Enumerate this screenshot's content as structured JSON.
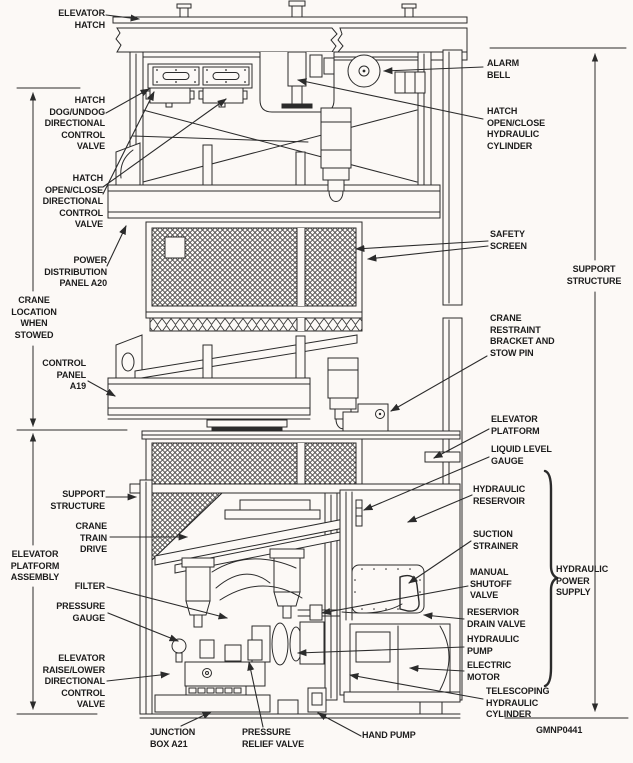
{
  "figure": {
    "code": "GMNP0441",
    "background": "#fcf9f6",
    "ink_color": "#2b2b2b",
    "subject": "Elevator platform assembly and hydraulic power supply cutaway diagram"
  },
  "labels": {
    "elevator_hatch": "ELEVATOR\nHATCH",
    "hatch_dog_undog": "HATCH\nDOG/UNDOG\nDIRECTIONAL\nCONTROL\nVALVE",
    "hatch_open_close_valve": "HATCH\nOPEN/CLOSE\nDIRECTIONAL\nCONTROL\nVALVE",
    "power_distribution": "POWER\nDISTRIBUTION\nPANEL A20",
    "crane_location": "CRANE\nLOCATION\nWHEN\nSTOWED",
    "control_panel": "CONTROL\nPANEL\nA19",
    "support_structure_left": "SUPPORT\nSTRUCTURE",
    "crane_train_drive": "CRANE\nTRAIN\nDRIVE",
    "elevator_platform_assembly": "ELEVATOR\nPLATFORM\nASSEMBLY",
    "filter": "FILTER",
    "pressure_gauge": "PRESSURE\nGAUGE",
    "elevator_raise_lower": "ELEVATOR\nRAISE/LOWER\nDIRECTIONAL\nCONTROL\nVALVE",
    "junction_box": "JUNCTION\nBOX A21",
    "pressure_relief_valve": "PRESSURE\nRELIEF VALVE",
    "hand_pump": "HAND PUMP",
    "alarm_bell": "ALARM\nBELL",
    "hatch_cylinder": "HATCH\nOPEN/CLOSE\nHYDRAULIC\nCYLINDER",
    "safety_screen": "SAFETY\nSCREEN",
    "support_structure_right": "SUPPORT\nSTRUCTURE",
    "crane_restraint": "CRANE\nRESTRAINT\nBRACKET AND\nSTOW PIN",
    "elevator_platform": "ELEVATOR\nPLATFORM",
    "liquid_level_gauge": "LIQUID LEVEL\nGAUGE",
    "hydraulic_reservoir": "HYDRAULIC\nRESERVOIR",
    "suction_strainer": "SUCTION\nSTRAINER",
    "manual_shutoff_valve": "MANUAL\nSHUTOFF\nVALVE",
    "hydraulic_power_supply": "HYDRAULIC\nPOWER\nSUPPLY",
    "reservior_drain_valve": "RESERVIOR\nDRAIN VALVE",
    "hydraulic_pump": "HYDRAULIC\nPUMP",
    "electric_motor": "ELECTRIC\nMOTOR",
    "telescoping_cylinder": "TELESCOPING\nHYDRAULIC\nCYLINDER",
    "figure_code": "GMNP0441"
  }
}
